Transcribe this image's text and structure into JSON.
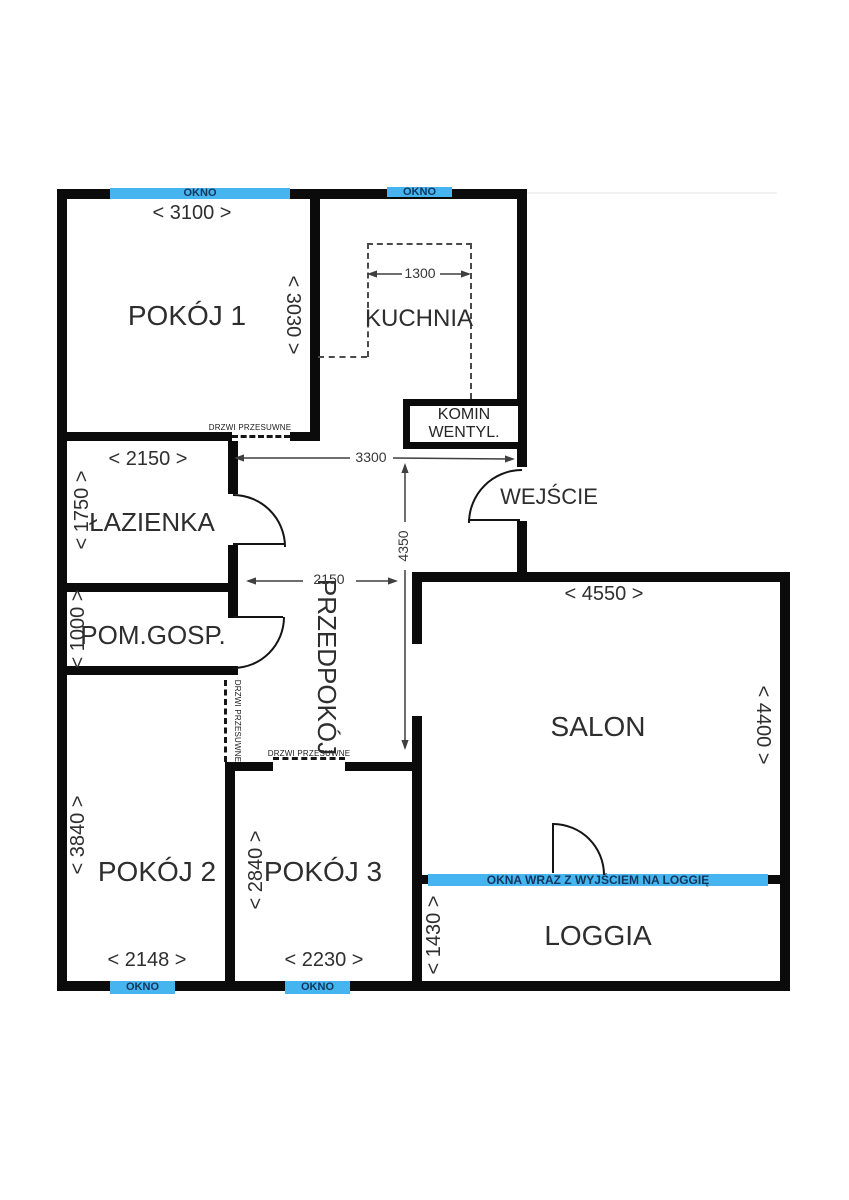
{
  "rooms": {
    "pokoj1": "POKÓJ 1",
    "kuchnia": "KUCHNIA",
    "komin_line1": "KOMIN",
    "komin_line2": "WENTYL.",
    "lazienka": "ŁAZIENKA",
    "wejscie": "WEJŚCIE",
    "pomgosp": "POM.GOSP.",
    "przedpokoj": "PRZEDPOKÓJ",
    "salon": "SALON",
    "pokoj2": "POKÓJ 2",
    "pokoj3": "POKÓJ 3",
    "loggia": "LOGGIA"
  },
  "dimensions": {
    "pokoj1_width": "< 3100 >",
    "pokoj1_depth": "< 3030 >",
    "kuchnia_width": "1300",
    "lazienka_width": "< 2150 >",
    "lazienka_depth": "< 1750 >",
    "korytarz_length": "3300",
    "przedpokoj_length": "4350",
    "pomgosp_depth": "< 1000 >",
    "przedpokoj_width": "2150",
    "salon_width": "< 4550 >",
    "salon_depth": "< 4400 >",
    "pokoj2_depth": "< 3840 >",
    "pokoj2_width": "< 2148 >",
    "pokoj3_depth": "< 2840 >",
    "pokoj3_width": "< 2230 >",
    "loggia_depth": "< 1430 >"
  },
  "labels": {
    "window": "OKNO",
    "sliding_door": "DRZWI PRZESUWNE",
    "loggia_window": "OKNA WRAZ Z WYJŚCIEM NA LOGGIĘ"
  },
  "colors": {
    "window_blue": "#45b4ef",
    "window_text": "#14365a",
    "wall_black": "#0b0b0b"
  }
}
